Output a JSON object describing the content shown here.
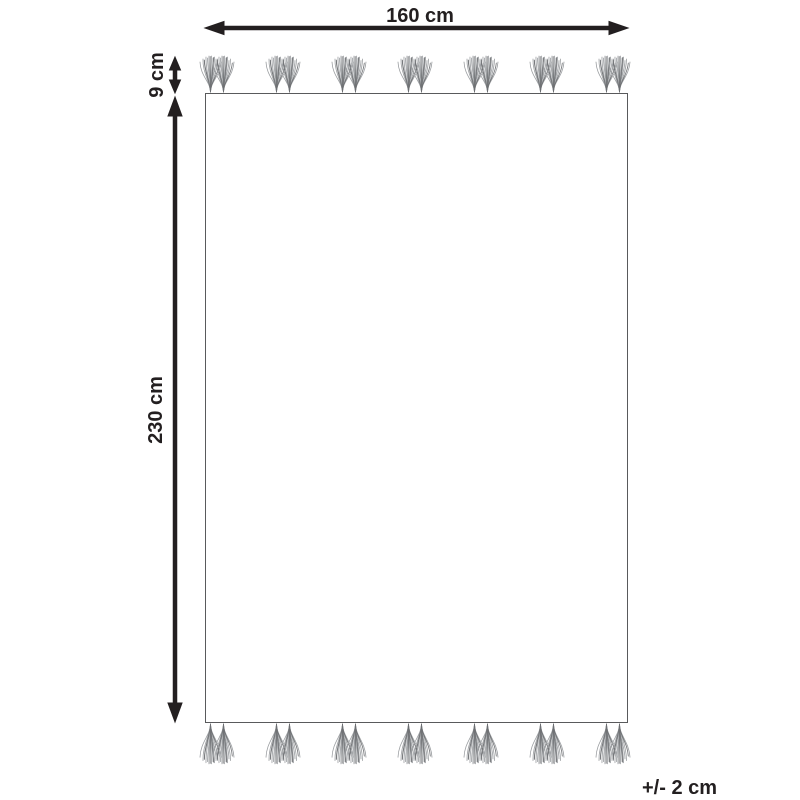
{
  "diagram": {
    "labels": {
      "width": "160 cm",
      "tassel_length": "9 cm",
      "height": "230 cm",
      "tolerance": "+/- 2 cm"
    },
    "rug": {
      "tassel_clusters_per_edge": 7,
      "tassels_per_cluster": 2
    },
    "colors": {
      "dimension_lines": "#231f20",
      "rug_border": "#595a5c",
      "tassel_light": "#9b9ea1",
      "tassel_dark": "#6d6f72",
      "background": "#ffffff"
    }
  }
}
